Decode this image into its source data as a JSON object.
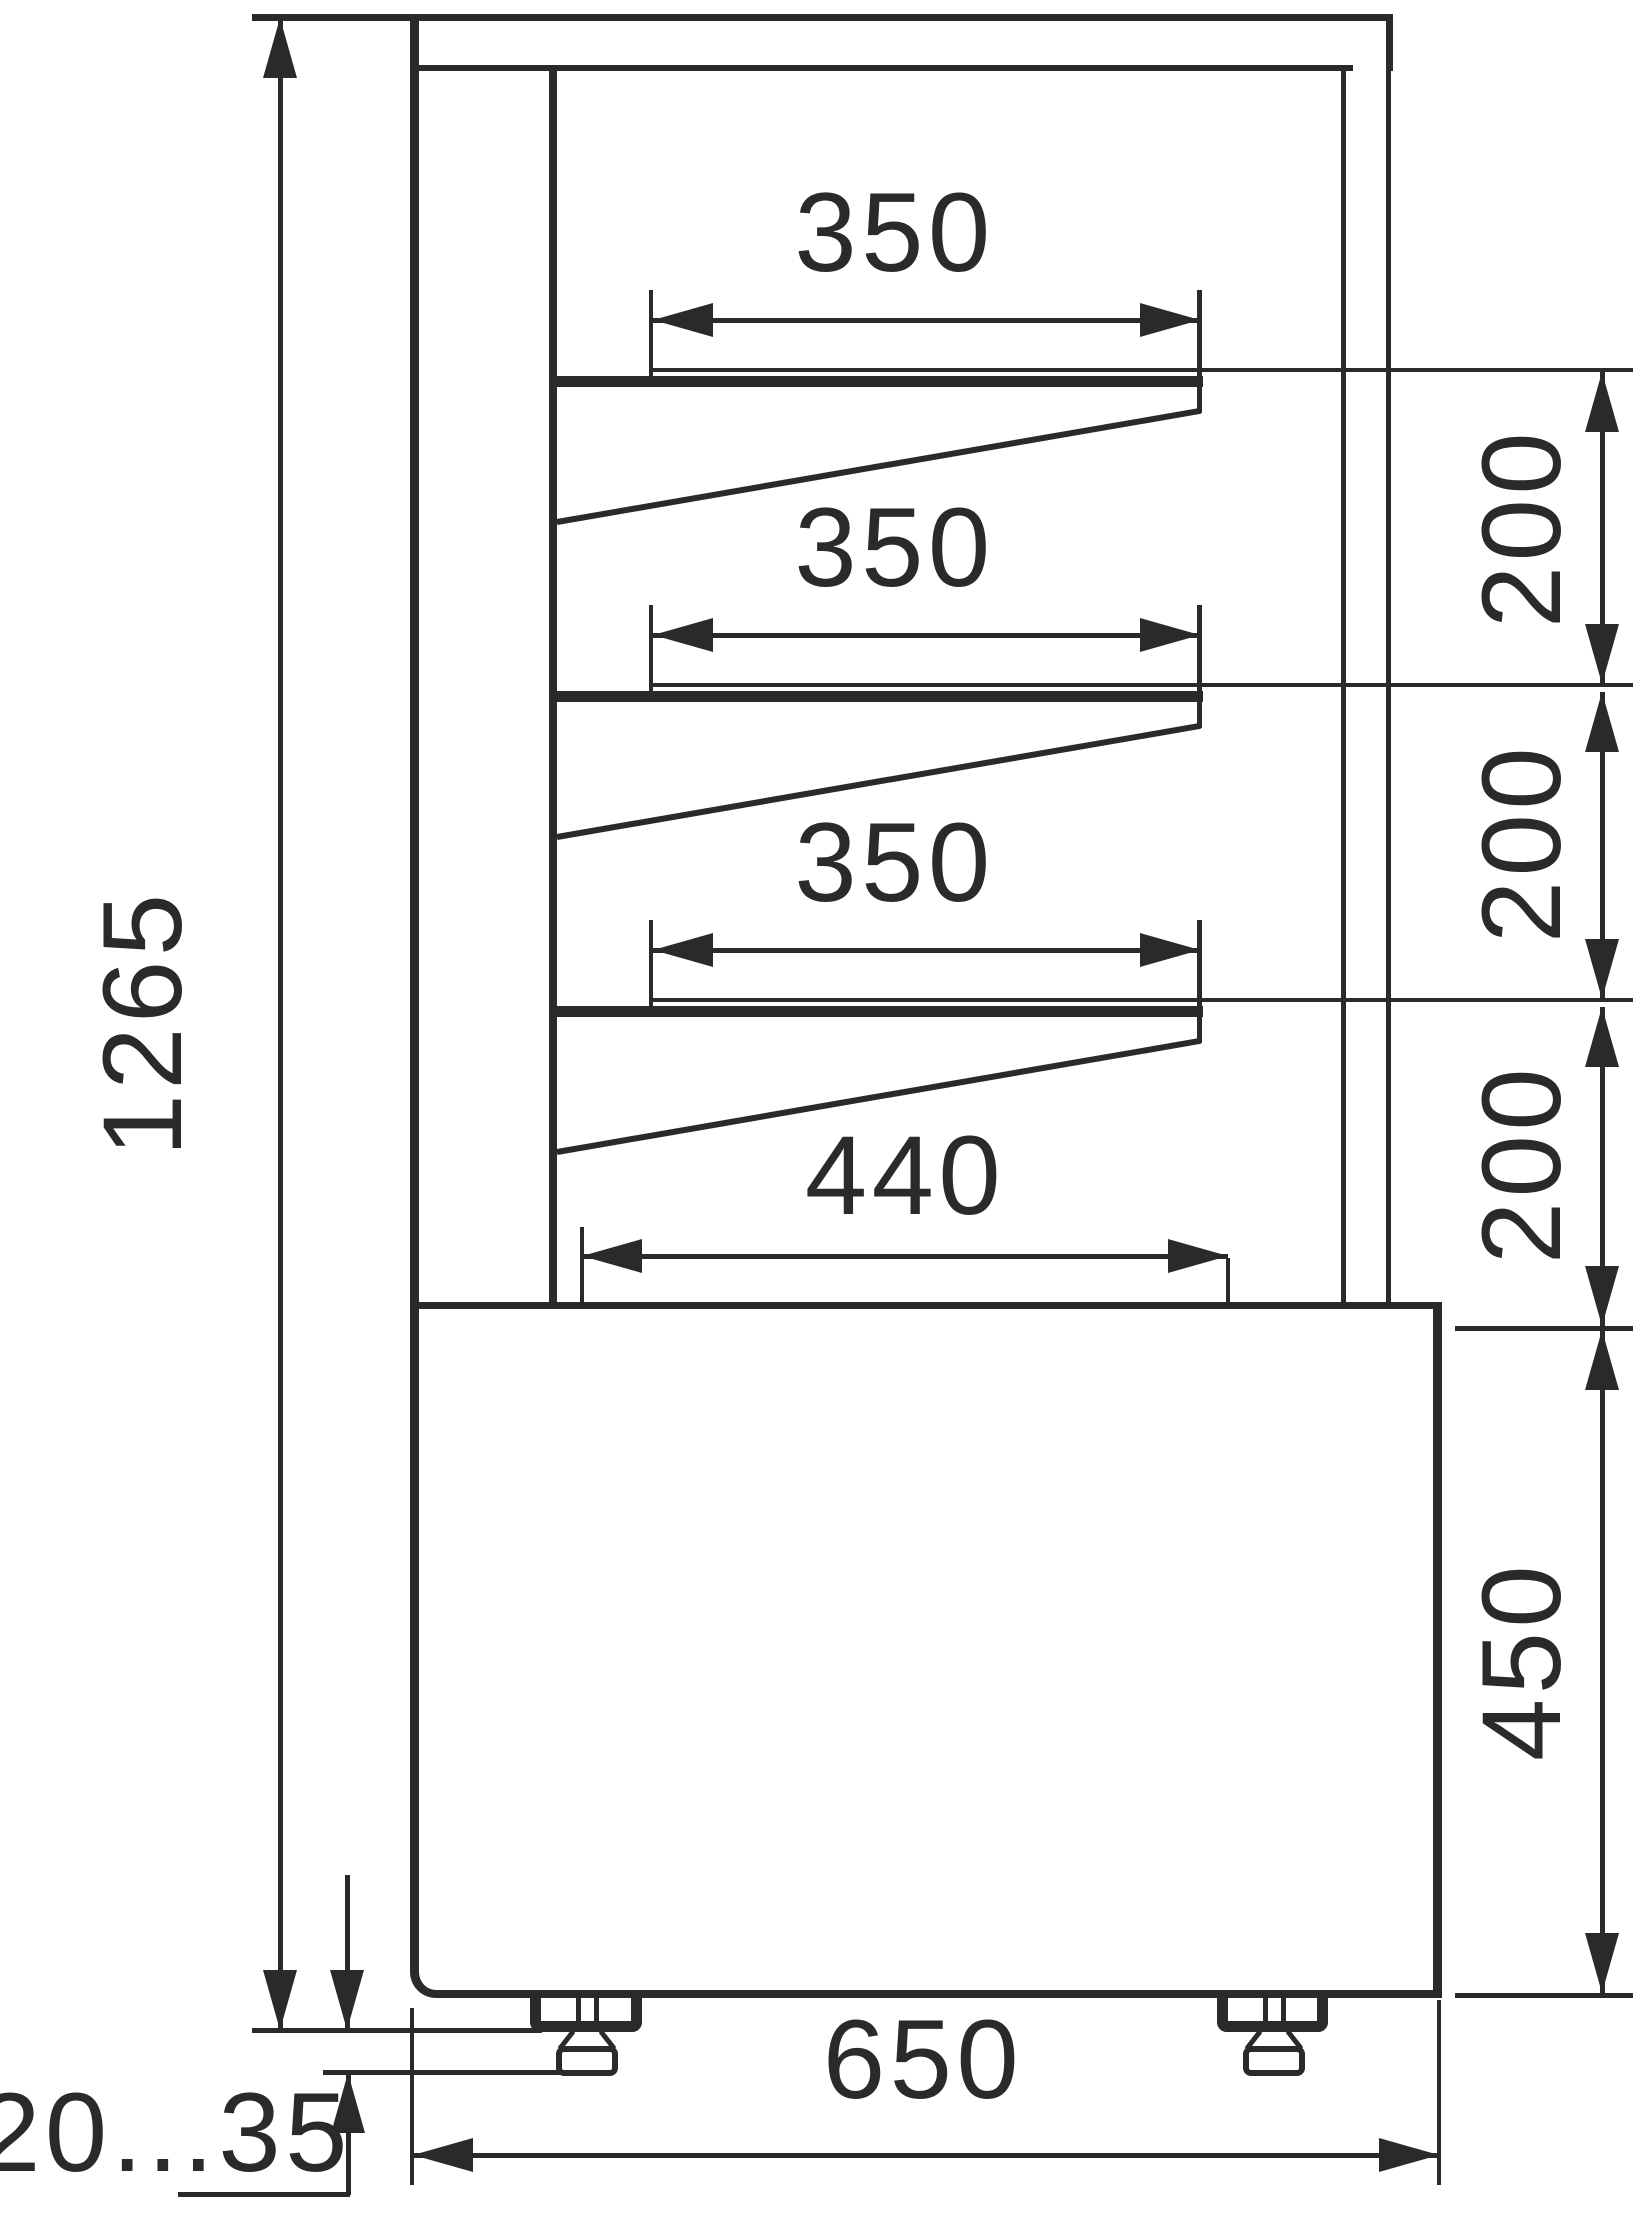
{
  "drawing": {
    "title": "display-case-side-section-dimensional-drawing",
    "labels": {
      "overall_height": "1265",
      "shelf_depths": [
        "350",
        "350",
        "350"
      ],
      "shelf_gaps": [
        "200",
        "200",
        "200"
      ],
      "bottom_shelf_depth": "440",
      "base_height": "450",
      "base_depth": "650",
      "foot_adjust_range": "20...35"
    },
    "colors": {
      "ink": "#2b2a29",
      "paper": "#ffffff"
    }
  }
}
